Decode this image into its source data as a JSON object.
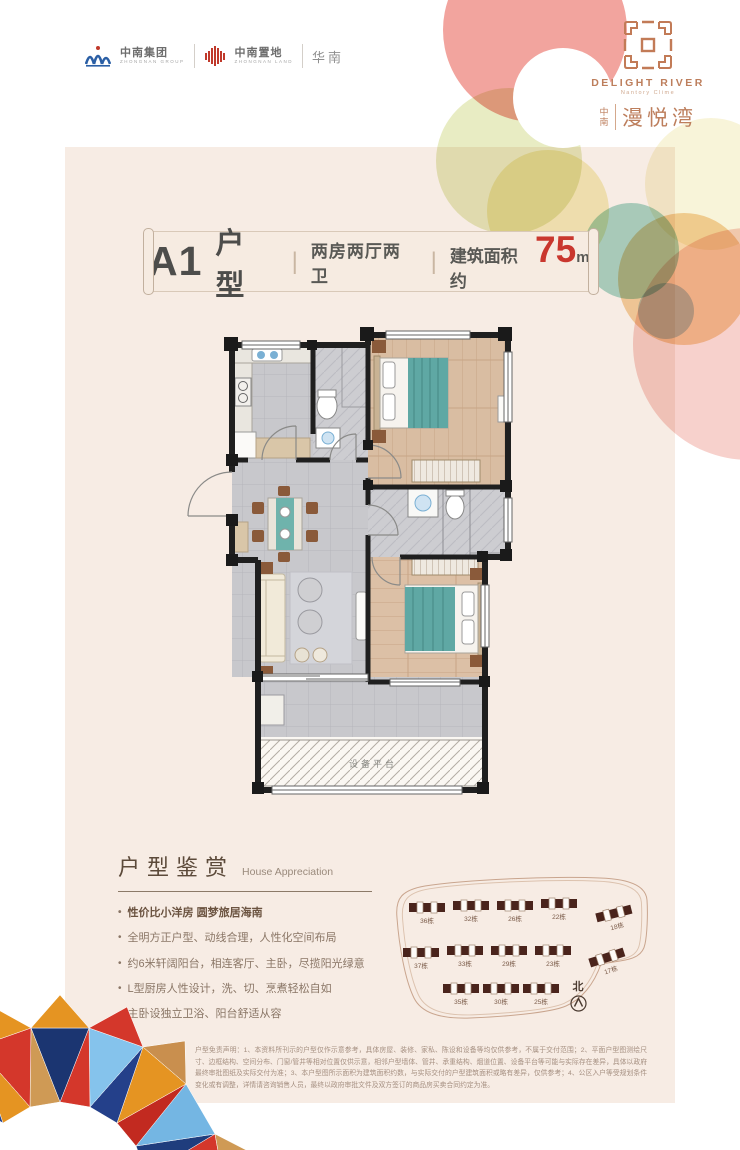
{
  "brand": {
    "group_name": "中南集团",
    "group_sub": "ZHONGNAN GROUP",
    "land_name": "中南置地",
    "land_sub": "ZHONGNAN LAND",
    "region": "华南",
    "logo_en": "DELIGHT RIVER",
    "logo_en_sub": "Nantory Clime",
    "logo_cn_prefix": "中南",
    "logo_cn": "漫悦湾"
  },
  "title": {
    "code": "A1",
    "type_label": "户型",
    "sep": "|",
    "layout": "两房两厅两卫",
    "area_prefix": "建筑面积约",
    "area_value": "75",
    "area_unit": "m",
    "area_sup": "2"
  },
  "floorplan": {
    "equipment_label": "设备平台"
  },
  "appreciation": {
    "heading": "户型鉴赏",
    "heading_en": "House Appreciation",
    "bullets": [
      "性价比小洋房 圆梦旅居海南",
      "全明方正户型、动线合理，人性化空间布局",
      "约6米轩阔阳台，相连客厅、主卧，尽揽阳光绿意",
      "L型厨房人性设计，洗、切、烹煮轻松自如",
      "主卧设独立卫浴、阳台舒适从容"
    ]
  },
  "siteplan": {
    "north_label": "北",
    "rows": [
      [
        "36栋",
        "32栋",
        "26栋",
        "22栋",
        "18栋"
      ],
      [
        "37栋",
        "33栋",
        "29栋",
        "23栋",
        "17栋"
      ],
      [
        "35栋",
        "30栋",
        "25栋"
      ]
    ]
  },
  "disclaimer": {
    "text": "户型免责声明：1、本资料所刊示的户型仅作示意参考，具体房屋、装修、家私、陈设和设备等均仅供参考，不属于交付范围；2、平面户型图测绘尺寸、边框结构、空间分布、门窗/管井等相对位置仅供示意，相邻户型墙体、管井、承重结构、烟道位置、设备平台等可能与实际存在差异，具体以政府最终审批图纸及实际交付为准；3、本户型图所示面积为建筑面积约数，与实际交付的户型建筑面积或略有差异，仅供参考；4、公区入户等受规划条件变化或有调整，详情请咨询销售人员，最终以政府审批文件及双方签订的商品房买卖合同约定为准。"
  },
  "colors": {
    "accent_red": "#c9372e",
    "brand_orange": "#bd7e5c",
    "panel_beige": "#f7ece4",
    "bed_teal": "#5fa8a4"
  }
}
